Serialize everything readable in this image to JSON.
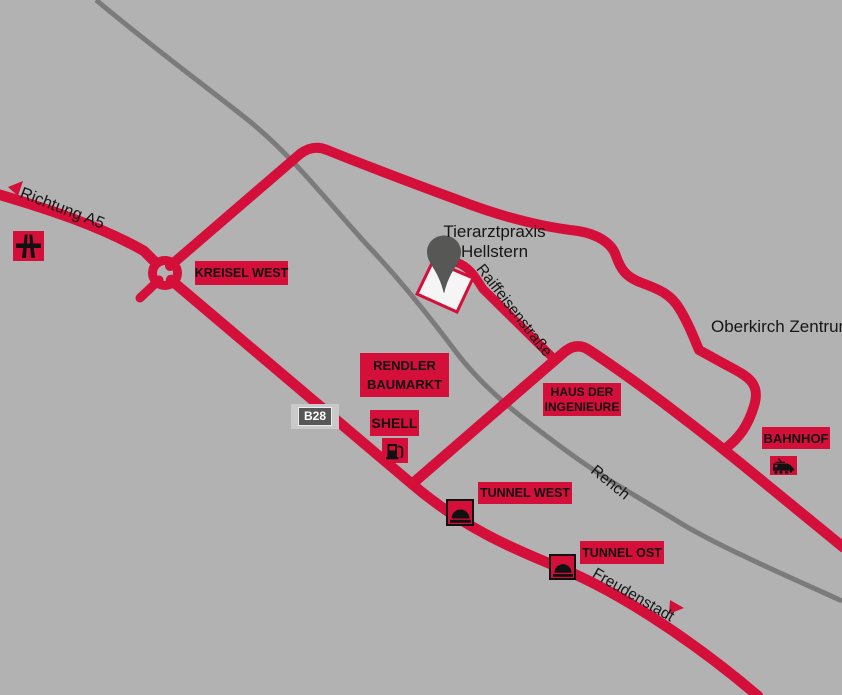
{
  "colors": {
    "background": "#b2b2b2",
    "road_red": "#d30f3a",
    "rench_line_gray": "#7b7b7b",
    "pin_gray": "#575756",
    "building_fill": "#f5f5f5",
    "label_box_bg": "#d30f3a",
    "label_text": "#121212",
    "b28_outer_bg": "#c9c9c9",
    "b28_inner_bg": "#575757",
    "b28_text": "#ffffff"
  },
  "labels": {
    "richtung_a5": "Richtung A5",
    "kreisel_west": "KREISEL WEST",
    "tierarztpraxis": {
      "line1": "Tierarztpraxis",
      "line2": "Hellstern"
    },
    "raiffeisenstrasse": "Raiffeisenstraße",
    "oberkirch_zentrum": "Oberkirch Zentrum",
    "rendler": {
      "line1": "RENDLER",
      "line2": "BAUMARKT"
    },
    "b28": "B28",
    "shell": "SHELL",
    "haus": {
      "line1": "HAUS DER",
      "line2": "INGENIEURE"
    },
    "bahnhof": "BAHNHOF",
    "tunnel_west": "TUNNEL WEST",
    "tunnel_ost": "TUNNEL OST",
    "rench": "Rench",
    "freudenstadt": "Freudenstadt"
  },
  "icons": {
    "motorway": "motorway-icon",
    "fuel": "fuel-pump-icon",
    "tunnel_west": "tunnel-icon",
    "tunnel_ost": "tunnel-icon",
    "train": "train-icon",
    "pin": "location-pin-icon",
    "arrow_a5": "arrow-left-icon",
    "arrow_freudenstadt": "arrow-right-icon"
  }
}
